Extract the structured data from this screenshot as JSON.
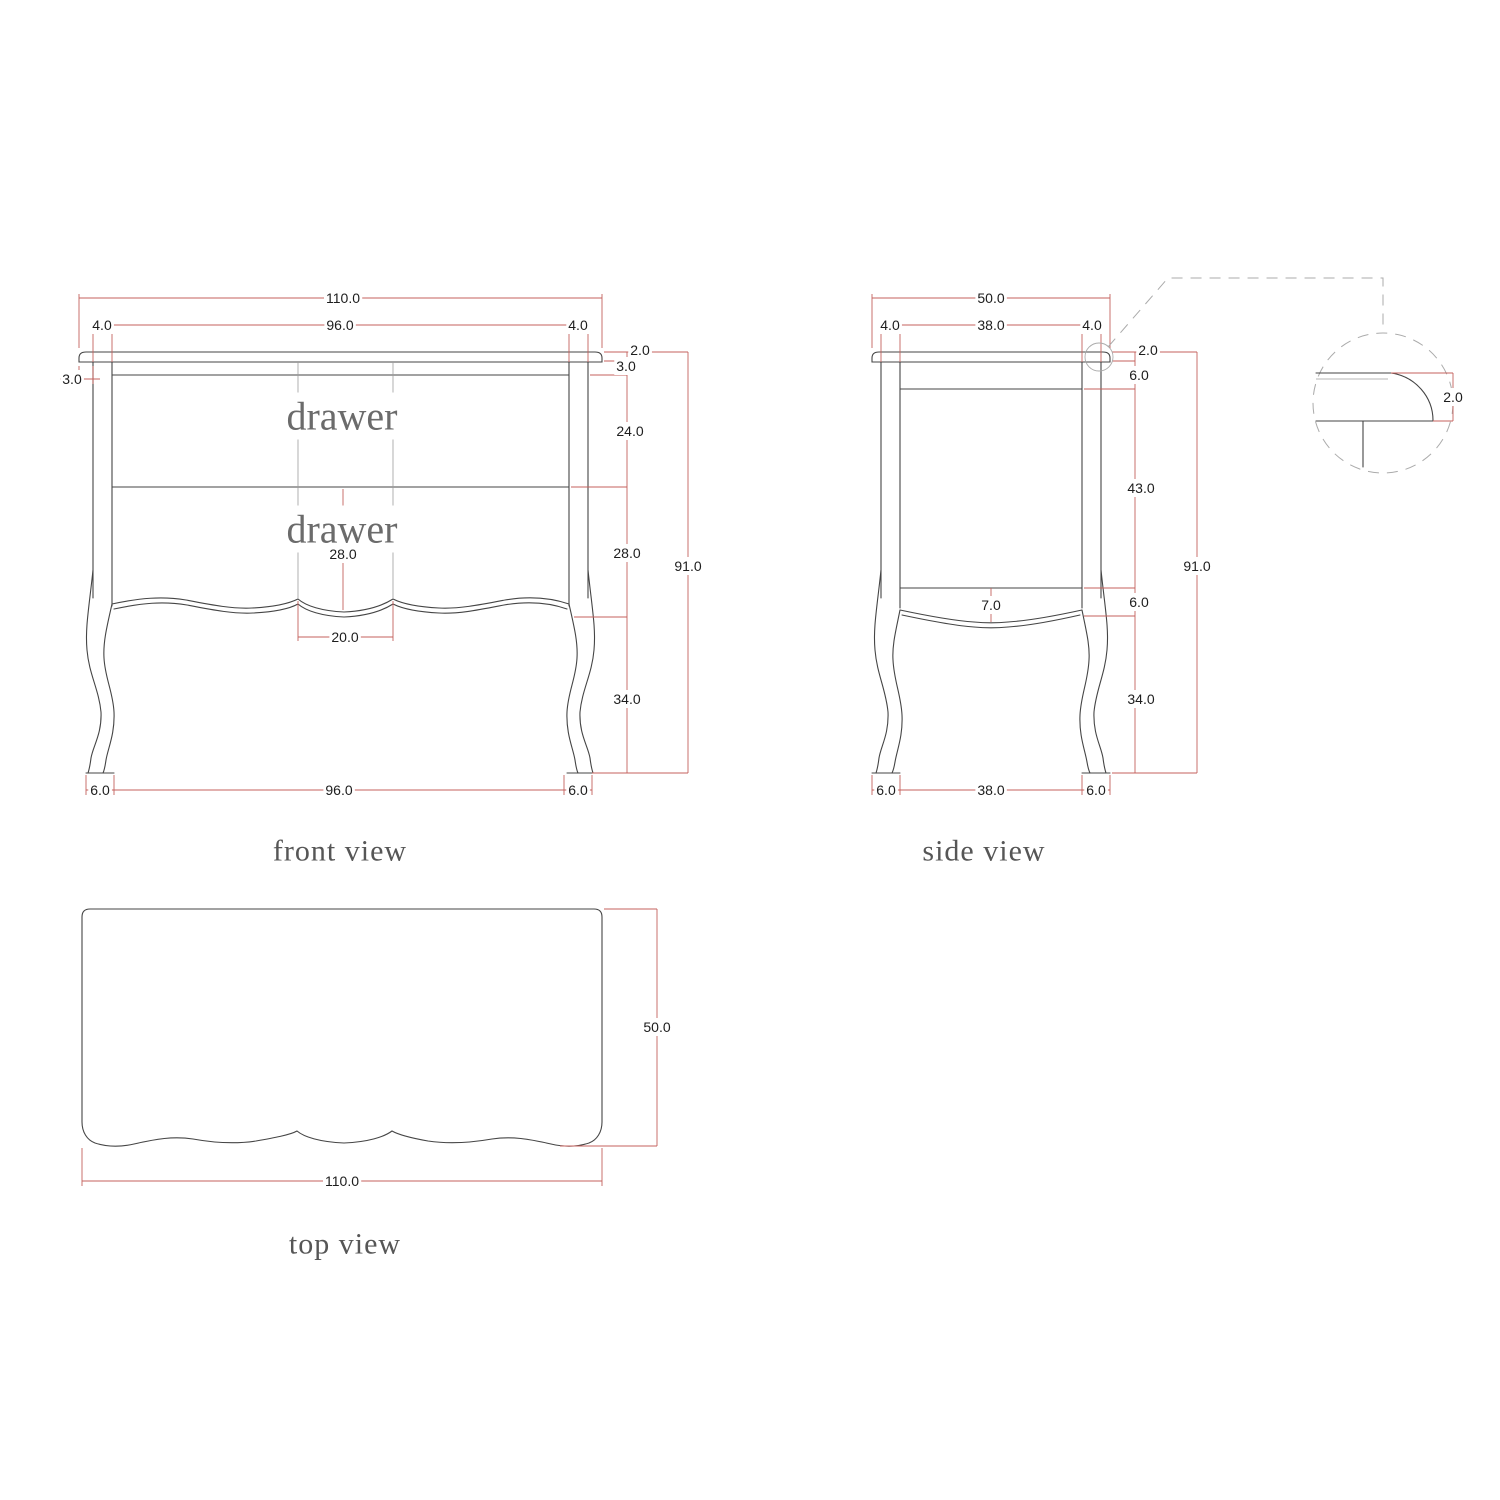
{
  "front_view": {
    "title": "front view",
    "drawer_top_label": "drawer",
    "drawer_bottom_label": "drawer",
    "dims": {
      "overall_width": "110.0",
      "drawer_opening_width": "96.0",
      "left_post_width": "4.0",
      "right_post_width": "4.0",
      "top_overhang": "3.0",
      "top_thickness": "2.0",
      "top_rail_height": "3.0",
      "top_drawer_height": "24.0",
      "bottom_drawer_height": "28.0",
      "bottom_drawer_height_center": "28.0",
      "handle_spacing": "20.0",
      "overall_height": "91.0",
      "leg_height": "34.0",
      "foot_left_width": "6.0",
      "feet_span": "96.0",
      "foot_right_width": "6.0"
    }
  },
  "side_view": {
    "title": "side view",
    "dims": {
      "overall_depth": "50.0",
      "inner_depth": "38.0",
      "front_post_width": "4.0",
      "back_post_width": "4.0",
      "top_thickness": "2.0",
      "top_rail_height": "6.0",
      "side_panel_height": "43.0",
      "bottom_rail_height": "6.0",
      "apron_drop": "7.0",
      "overall_height": "91.0",
      "leg_height": "34.0",
      "foot_front_width": "6.0",
      "feet_span": "38.0",
      "foot_back_width": "6.0"
    }
  },
  "top_view": {
    "title": "top view",
    "dims": {
      "overall_width": "110.0",
      "overall_depth": "50.0"
    }
  },
  "detail_view": {
    "dims": {
      "top_edge_thickness": "2.0"
    }
  },
  "colors": {
    "dimension_red": "#c4615c",
    "structure_gray": "#454545",
    "callout_gray": "#ababab"
  }
}
